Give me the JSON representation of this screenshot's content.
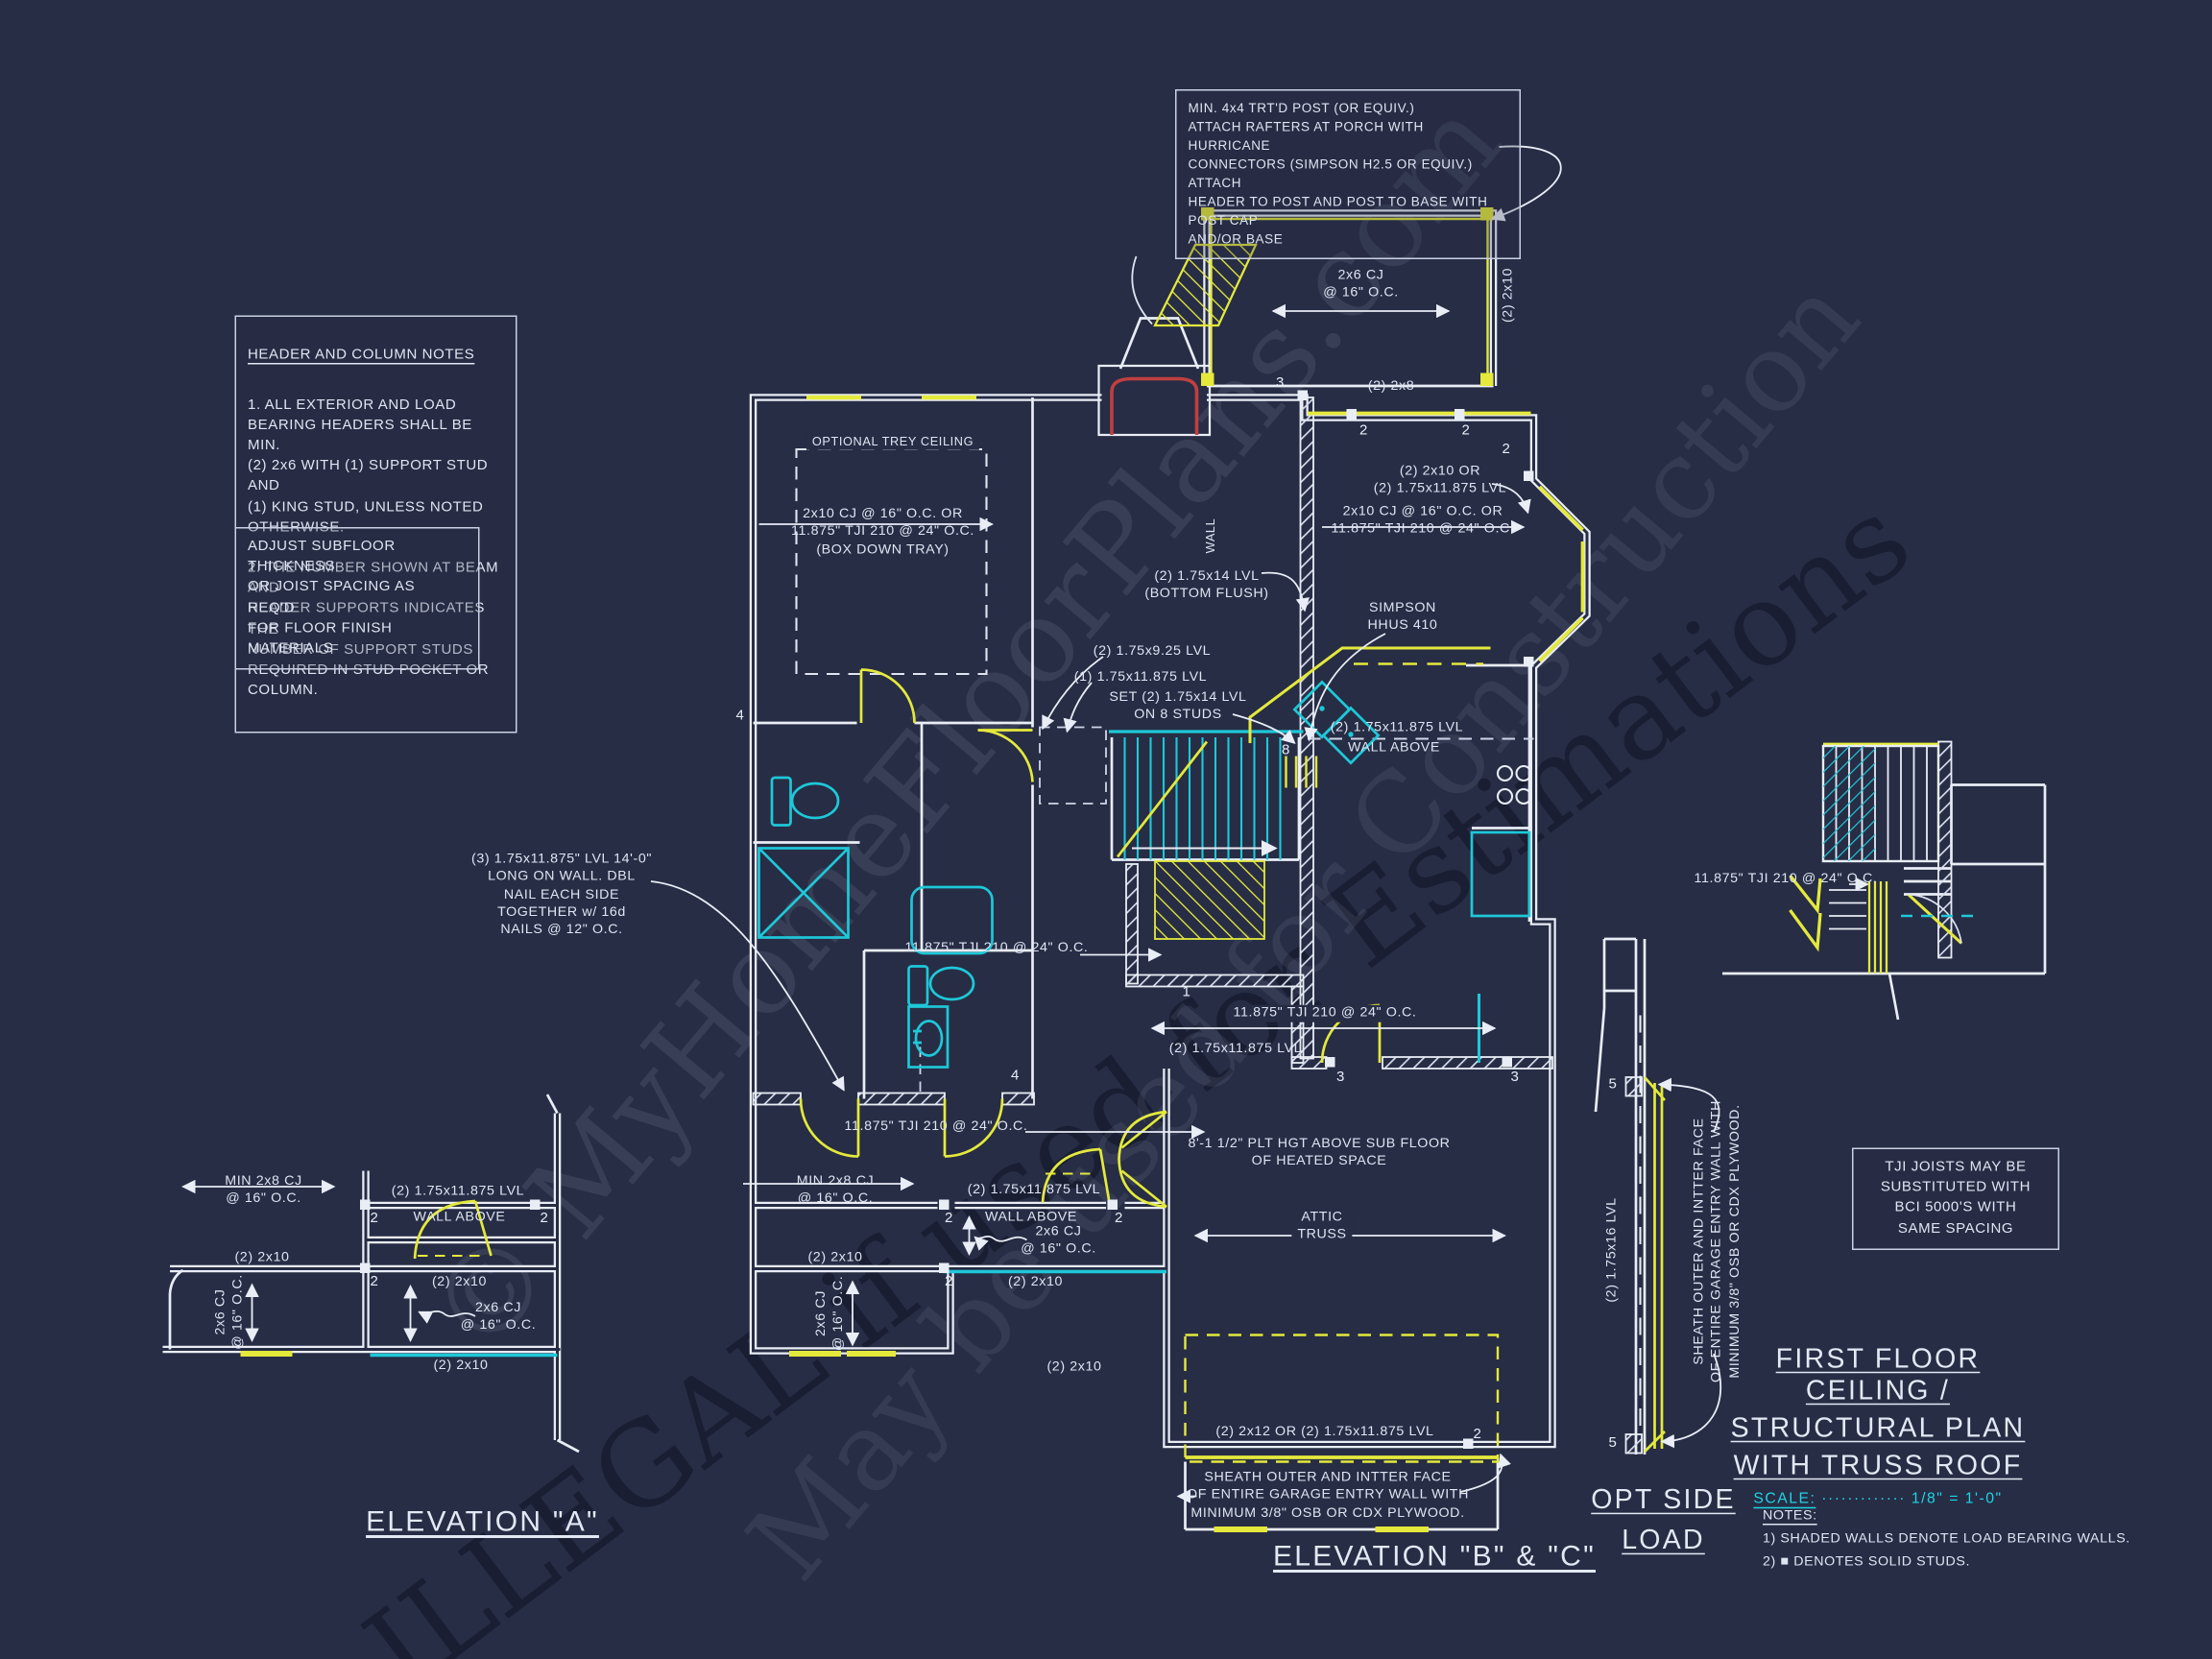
{
  "watermark": {
    "wm1": "© MyHomeFloorPlans.com",
    "wm2": "ILLEGAL if used for Estimations",
    "wm3": "May be used for Construction"
  },
  "notes": {
    "post_note": "MIN. 4x4 TRT'D POST (OR EQUIV.)\nATTACH RAFTERS AT PORCH WITH HURRICANE\nCONNECTORS (SIMPSON H2.5 OR EQUIV.) ATTACH\nHEADER TO POST AND POST TO BASE WITH POST CAP\nAND/OR BASE",
    "header_notes_title": "HEADER AND COLUMN NOTES",
    "header_notes_body": "1. ALL EXTERIOR AND LOAD\nBEARING HEADERS SHALL BE MIN.\n(2) 2x6 WITH (1) SUPPORT STUD AND\n(1) KING STUD, UNLESS NOTED\nOTHERWISE.\n\n2. THE NUMBER SHOWN AT BEAM AND\nHEADER SUPPORTS INDICATES THE\nNUMBER OF SUPPORT STUDS\nREQUIRED IN STUD POCKET OR\nCOLUMN.",
    "subfloor_note": "ADJUST SUBFLOOR THICKNESS\nOR JOIST SPACING AS REQ'D\nFOR FLOOR FINISH MATERIALS",
    "tji_note": "TJI JOISTS MAY BE\nSUBSTITUTED WITH\nBCI 5000'S WITH\nSAME SPACING",
    "lvl_note": "(3) 1.75x11.875\" LVL 14'-0\"\nLONG ON WALL.  DBL\nNAIL EACH SIDE\nTOGETHER w/ 16d\nNAILS @ 12\" O.C.",
    "sheath_note": "SHEATH OUTER AND INTTER FACE\nOF ENTIRE GARAGE ENTRY WALL WITH\nMINIMUM 3/8\" OSB OR CDX PLYWOOD."
  },
  "plan_labels": {
    "trey_title": "OPTIONAL TREY CEILING",
    "trey_joist": "2x10 CJ @ 16\" O.C. OR\n11.875\" TJI 210 @ 24\" O.C.\n(BOX DOWN TRAY)",
    "porch_cj": "2x6 CJ\n@ 16\" O.C.",
    "two_2x10": "(2) 2x10",
    "two_2x8": "(2) 2x8",
    "wall": "WALL",
    "right_lvl": "(2) 2x10 OR\n(2) 1.75x11.875 LVL",
    "right_cj": "2x10 CJ @ 16\" O.C. OR\n11.875\" TJI 210 @ 24\" O.C.",
    "lvl14_flush": "(2) 1.75x14 LVL\n(BOTTOM FLUSH)",
    "simpson": "SIMPSON\nHHUS 410",
    "lvl925": "(2) 1.75x9.25 LVL",
    "lvl11875_one": "(1) 1.75x11.875 LVL",
    "set_lvl14": "SET (2) 1.75x14 LVL\nON 8 STUDS",
    "lvl11875_two": "(2) 1.75x11.875 LVL",
    "wall_above": "WALL ABOVE",
    "tji": "11.875\" TJI 210 @ 24\" O.C.",
    "plt_hgt": "8'-1 1/2\" PLT HGT ABOVE SUB FLOOR\nOF HEATED SPACE",
    "attic_truss": "ATTIC\nTRUSS",
    "garage_hdr": "(2) 2x12 OR (2) 1.75x11.875 LVL",
    "min_2x8": "MIN 2x8 CJ\n@ 16\" O.C.",
    "cj_2x6": "2x6 CJ\n@ 16\" O.C.",
    "lvl16": "(2) 1.75x16 LVL"
  },
  "studs": {
    "n1": "1",
    "n2": "2",
    "n3": "3",
    "n4": "4",
    "n5": "5",
    "n8": "8"
  },
  "section_labels": {
    "elevation_a": "ELEVATION \"A\"",
    "elevation_bc": "ELEVATION \"B\" & \"C\"",
    "opt_side_load": "OPT SIDE\nLOAD"
  },
  "titleblock": {
    "line1": "FIRST FLOOR CEILING /",
    "line2": "STRUCTURAL PLAN",
    "line3": "WITH TRUSS ROOF",
    "scale_label": "SCALE:",
    "scale_dots": "·············",
    "scale_value": "1/8\" = 1'-0\"",
    "notes_title": "NOTES:",
    "note1": "1) SHADED WALLS DENOTE LOAD BEARING WALLS.",
    "note2": "2) ■ DENOTES SOLID STUDS."
  },
  "colors": {
    "background": "#272d45",
    "line": "#e9edf6",
    "cyan": "#1ec8d8",
    "yellow": "#e4e93c",
    "red": "#bf4040"
  }
}
